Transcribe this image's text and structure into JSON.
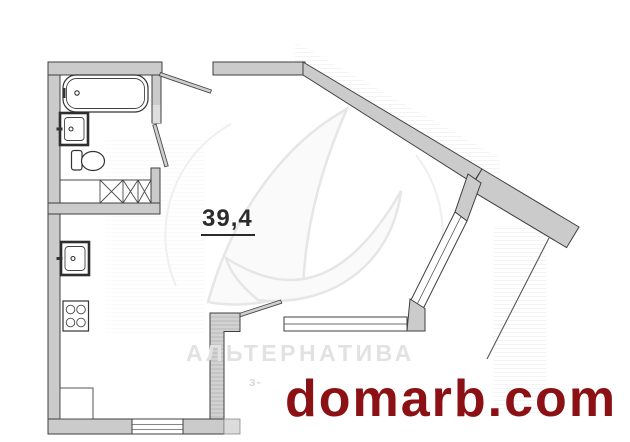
{
  "plan": {
    "area_label": "39,4",
    "watermark": {
      "brand_text": "АЛЬТЕРНАТИВА",
      "sub_text": "з-"
    },
    "site": {
      "label": "domarb.com",
      "color": "#8b1115"
    },
    "colors": {
      "wall_fill": "#cbcbcb",
      "wall_fill_light": "#dcdcdc",
      "wall_stroke": "#3f3f3f",
      "window_fill": "#ffffff",
      "watermark_gray": "#e2e2e2",
      "area_text": "#2b2b2b"
    },
    "fixtures": [
      "bathtub",
      "bathroom-sink",
      "toilet",
      "closet-folding-doors",
      "kitchen-sink",
      "stove-4-burners",
      "corner-counter"
    ],
    "openings": [
      "entrance-door",
      "bathroom-door",
      "balcony-door",
      "diagonal-window",
      "south-window",
      "kitchen-window"
    ]
  }
}
